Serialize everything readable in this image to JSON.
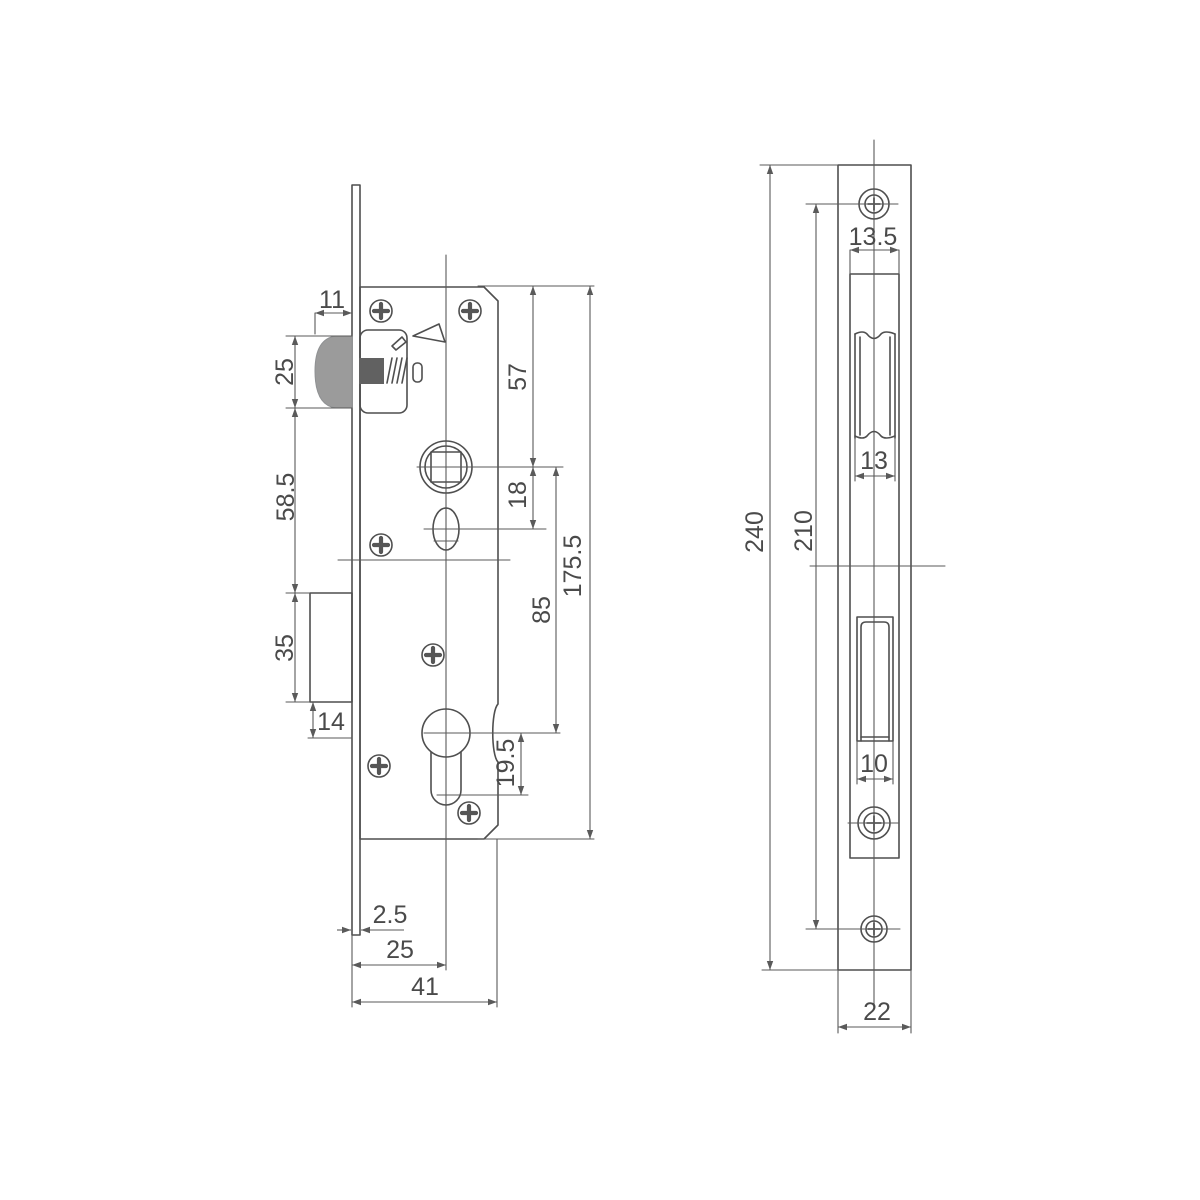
{
  "diagram": {
    "kind": "technical-drawing",
    "subject": "mortise door lock body and faceplate dimension drawing",
    "side_view": {
      "name": "lock-body-side-view",
      "dims": {
        "latch_protrusion": "11",
        "latch_height": "25",
        "latch_to_bolt": "58.5",
        "bolt_height": "35",
        "bolt_to_cylinder": "14",
        "top_to_spindle": "57",
        "spindle_to_follower": "18",
        "spindle_to_cylinder": "85",
        "case_height": "175.5",
        "cylinder_reach": "19.5",
        "plate_thickness": "2.5",
        "backset": "25",
        "case_depth": "41"
      }
    },
    "front_view": {
      "name": "faceplate-front-view",
      "dims": {
        "plate_height": "240",
        "screw_spacing": "210",
        "latch_cutout_width": "13.5",
        "latch_width": "13",
        "bolt_cutout_width": "10",
        "plate_width": "22"
      }
    },
    "colors": {
      "background": "#ffffff",
      "line": "#4f4f4f",
      "text": "#4a4a4a",
      "latch_head_fill": "#9b9b9b",
      "bolt_shaft_fill": "#616161"
    }
  }
}
